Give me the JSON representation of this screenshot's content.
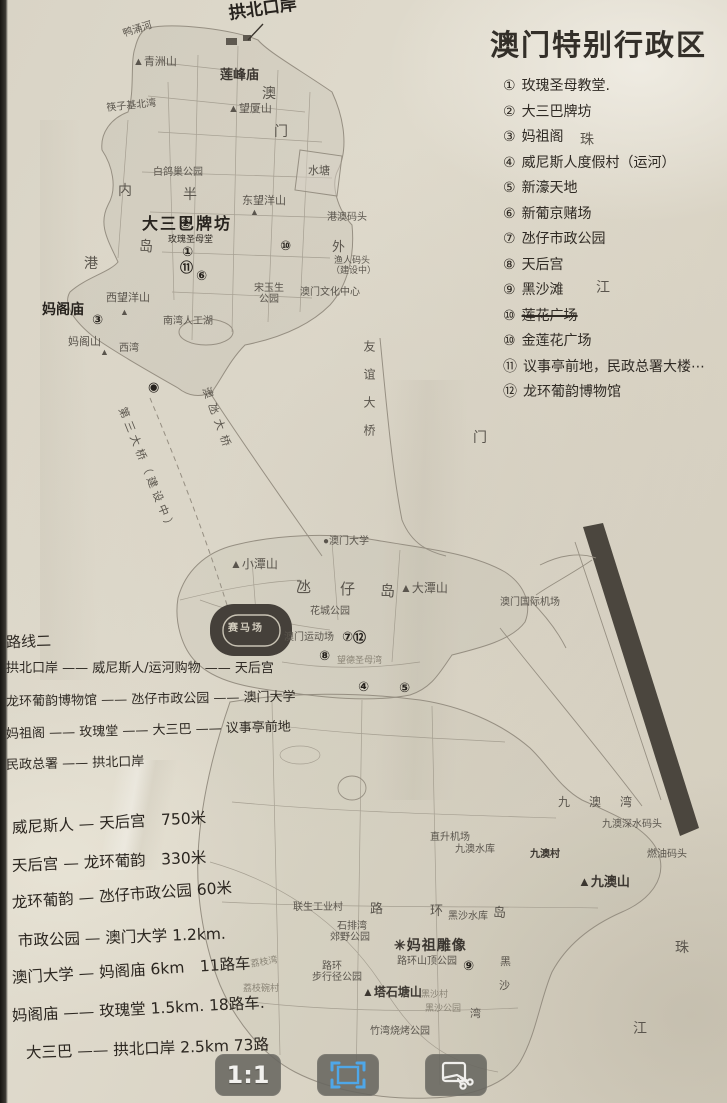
{
  "title": "澳门特别行政区",
  "legend": {
    "items": [
      {
        "num": "①",
        "text": "玫瑰圣母教堂."
      },
      {
        "num": "②",
        "text": "大三巴牌坊"
      },
      {
        "num": "③",
        "text": "妈祖阁"
      },
      {
        "num": "④",
        "text": "威尼斯人度假村（运河）"
      },
      {
        "num": "⑤",
        "text": "新濠天地"
      },
      {
        "num": "⑥",
        "text": "新葡京赌场"
      },
      {
        "num": "⑦",
        "text": "氹仔市政公园"
      },
      {
        "num": "⑧",
        "text": "天后宫"
      },
      {
        "num": "⑨",
        "text": "黑沙滩"
      },
      {
        "num": "⑩",
        "text": "莲花广场",
        "strike": true
      },
      {
        "num": "⑩",
        "text": "金莲花广场"
      },
      {
        "num": "⑪",
        "text": "议事亭前地，民政总署大楼⋯"
      },
      {
        "num": "⑫",
        "text": "龙环葡韵博物馆"
      }
    ]
  },
  "route_notes": {
    "heading": "路线二",
    "lines": [
      "拱北口岸 —— 威尼斯人/运河购物 —— 天后宫",
      "龙环葡韵博物馆 —— 氹仔市政公园 —— 澳门大学",
      "妈祖阁 —— 玫瑰堂 —— 大三巴 —— 议事亭前地",
      "民政总署 —— 拱北口岸"
    ]
  },
  "distance_notes": {
    "lines": [
      "威尼斯人 — 天后宫　750米",
      "天后宫 — 龙环葡韵　330米",
      "龙环葡韵 — 氹仔市政公园 60米",
      "市政公园 — 澳门大学 1.2km.",
      "澳门大学 — 妈阁庙 6km　11路车",
      "妈阁庙 —— 玫瑰堂 1.5km. 18路车.",
      "大三巴 —— 拱北口岸 2.5km 73路"
    ]
  },
  "map": {
    "labels": [
      {
        "t": "拱北口岸",
        "x": 228,
        "y": 6,
        "c": "hb",
        "fs": 17,
        "rot": -8
      },
      {
        "t": "鸭涌河",
        "x": 122,
        "y": 30,
        "c": "p",
        "rot": -18,
        "fs": 10
      },
      {
        "t": "▲青洲山",
        "x": 133,
        "y": 57,
        "c": "p",
        "fs": 11
      },
      {
        "t": "莲峰庙",
        "x": 220,
        "y": 68,
        "c": "pb",
        "fs": 13
      },
      {
        "t": "澳",
        "x": 262,
        "y": 88,
        "c": "p",
        "fs": 14
      },
      {
        "t": "门",
        "x": 274,
        "y": 126,
        "c": "p",
        "fs": 14
      },
      {
        "t": "▲望厦山",
        "x": 228,
        "y": 104,
        "c": "p",
        "fs": 11
      },
      {
        "t": "筷子基北湾",
        "x": 106,
        "y": 104,
        "c": "p",
        "rot": -6,
        "fs": 10
      },
      {
        "t": "水塘",
        "x": 308,
        "y": 166,
        "c": "p",
        "fs": 11
      },
      {
        "t": "内",
        "x": 118,
        "y": 185,
        "c": "p",
        "fs": 14
      },
      {
        "t": "港",
        "x": 84,
        "y": 258,
        "c": "p",
        "fs": 14
      },
      {
        "t": "半",
        "x": 183,
        "y": 189,
        "c": "p",
        "fs": 14
      },
      {
        "t": "岛",
        "x": 139,
        "y": 241,
        "c": "p",
        "fs": 14
      },
      {
        "t": "白鸽巢公园",
        "x": 153,
        "y": 168,
        "c": "p",
        "fs": 10
      },
      {
        "t": "东望洋山",
        "x": 242,
        "y": 196,
        "c": "p",
        "fs": 11
      },
      {
        "t": "▲",
        "x": 250,
        "y": 208,
        "c": "p",
        "fs": 9
      },
      {
        "t": "港澳码头",
        "x": 327,
        "y": 213,
        "c": "p",
        "fs": 10
      },
      {
        "t": "大三巴牌坊",
        "x": 142,
        "y": 216,
        "c": "hb",
        "fs": 16,
        "ls": 2
      },
      {
        "t": "玫瑰圣母堂",
        "x": 168,
        "y": 236,
        "c": "h",
        "fs": 9
      },
      {
        "t": "外",
        "x": 332,
        "y": 240,
        "c": "p",
        "fs": 13
      },
      {
        "t": "渔人码头",
        "x": 334,
        "y": 256,
        "c": "p",
        "fs": 9
      },
      {
        "t": "（建设中）",
        "x": 331,
        "y": 266,
        "c": "p",
        "fs": 9
      },
      {
        "t": "珠",
        "x": 580,
        "y": 134,
        "c": "p",
        "fs": 14
      },
      {
        "t": "江",
        "x": 596,
        "y": 282,
        "c": "p",
        "fs": 14
      },
      {
        "t": "宋玉生",
        "x": 254,
        "y": 284,
        "c": "p",
        "fs": 10
      },
      {
        "t": "公园",
        "x": 259,
        "y": 295,
        "c": "p",
        "fs": 10
      },
      {
        "t": "澳门文化中心",
        "x": 300,
        "y": 288,
        "c": "p",
        "fs": 10
      },
      {
        "t": "南湾人工湖",
        "x": 163,
        "y": 317,
        "c": "p",
        "fs": 10
      },
      {
        "t": "西望洋山",
        "x": 106,
        "y": 293,
        "c": "p",
        "fs": 11
      },
      {
        "t": "▲",
        "x": 120,
        "y": 308,
        "c": "p",
        "fs": 9
      },
      {
        "t": "妈阁庙",
        "x": 42,
        "y": 303,
        "c": "hb",
        "fs": 14
      },
      {
        "t": "妈阁山",
        "x": 68,
        "y": 337,
        "c": "p",
        "fs": 11
      },
      {
        "t": "▲",
        "x": 100,
        "y": 348,
        "c": "p",
        "fs": 9
      },
      {
        "t": "西湾",
        "x": 119,
        "y": 344,
        "c": "p",
        "fs": 10
      },
      {
        "t": "第三大桥（建设中）",
        "x": 126,
        "y": 406,
        "c": "p",
        "rot": 68,
        "ls": 4,
        "fs": 11
      },
      {
        "t": "澳氹大桥",
        "x": 210,
        "y": 386,
        "c": "p",
        "rot": 70,
        "ls": 6,
        "fs": 11
      },
      {
        "t": "友谊大桥",
        "x": 363,
        "y": 340,
        "c": "p",
        "vert": true,
        "ls": 16,
        "fs": 12
      },
      {
        "t": "门",
        "x": 473,
        "y": 432,
        "c": "p",
        "fs": 14
      },
      {
        "t": "●澳门大学",
        "x": 323,
        "y": 537,
        "c": "p",
        "fs": 10
      },
      {
        "t": "▲小潭山",
        "x": 230,
        "y": 558,
        "c": "p",
        "fs": 12
      },
      {
        "t": "氹",
        "x": 296,
        "y": 581,
        "c": "p",
        "fs": 15
      },
      {
        "t": "仔",
        "x": 340,
        "y": 583,
        "c": "p",
        "fs": 15
      },
      {
        "t": "岛",
        "x": 380,
        "y": 585,
        "c": "p",
        "fs": 15
      },
      {
        "t": "▲大潭山",
        "x": 400,
        "y": 582,
        "c": "p",
        "fs": 12
      },
      {
        "t": "花城公园",
        "x": 310,
        "y": 607,
        "c": "p",
        "fs": 10
      },
      {
        "t": "澳门运动场",
        "x": 284,
        "y": 633,
        "c": "p",
        "fs": 10
      },
      {
        "t": "赛马场",
        "x": 228,
        "y": 624,
        "c": "lt",
        "fs": 10,
        "ls": 2
      },
      {
        "t": "澳门国际机场",
        "x": 500,
        "y": 598,
        "c": "p",
        "fs": 10
      },
      {
        "t": "望德圣母湾",
        "x": 337,
        "y": 656,
        "c": "f",
        "fs": 9
      },
      {
        "t": "九 澳 湾",
        "x": 558,
        "y": 796,
        "c": "p",
        "fs": 12,
        "ls": 8
      },
      {
        "t": "九澳深水码头",
        "x": 602,
        "y": 820,
        "c": "p",
        "fs": 10
      },
      {
        "t": "直升机场",
        "x": 430,
        "y": 833,
        "c": "p",
        "fs": 10
      },
      {
        "t": "九澳水库",
        "x": 455,
        "y": 845,
        "c": "p",
        "fs": 10
      },
      {
        "t": "九澳村",
        "x": 530,
        "y": 850,
        "c": "pb",
        "fs": 10
      },
      {
        "t": "燃油码头",
        "x": 647,
        "y": 850,
        "c": "p",
        "fs": 10
      },
      {
        "t": "▲九澳山",
        "x": 578,
        "y": 875,
        "c": "pb",
        "fs": 13
      },
      {
        "t": "路",
        "x": 370,
        "y": 902,
        "c": "p",
        "fs": 13
      },
      {
        "t": "环",
        "x": 430,
        "y": 904,
        "c": "p",
        "fs": 13
      },
      {
        "t": "岛",
        "x": 493,
        "y": 906,
        "c": "p",
        "fs": 13
      },
      {
        "t": "黑沙水库",
        "x": 448,
        "y": 912,
        "c": "p",
        "fs": 10
      },
      {
        "t": "联生工业村",
        "x": 293,
        "y": 903,
        "c": "p",
        "fs": 10
      },
      {
        "t": "石排湾",
        "x": 337,
        "y": 922,
        "c": "p",
        "fs": 10
      },
      {
        "t": "郊野公园",
        "x": 330,
        "y": 933,
        "c": "p",
        "fs": 10
      },
      {
        "t": "荔枝湾",
        "x": 250,
        "y": 960,
        "c": "f",
        "fs": 9,
        "rot": -10
      },
      {
        "t": "荔枝碗村",
        "x": 243,
        "y": 984,
        "c": "f",
        "fs": 9
      },
      {
        "t": "✳妈祖雕像",
        "x": 394,
        "y": 940,
        "c": "pb",
        "fs": 14,
        "ls": 1
      },
      {
        "t": "路环山顶公园",
        "x": 397,
        "y": 957,
        "c": "p",
        "fs": 10
      },
      {
        "t": "路环",
        "x": 322,
        "y": 962,
        "c": "p",
        "fs": 10
      },
      {
        "t": "步行径公园",
        "x": 312,
        "y": 973,
        "c": "p",
        "fs": 10
      },
      {
        "t": "▲塔石塘山",
        "x": 362,
        "y": 986,
        "c": "pb",
        "fs": 12
      },
      {
        "t": "黑沙村",
        "x": 421,
        "y": 990,
        "c": "f",
        "fs": 9
      },
      {
        "t": "黑沙公园",
        "x": 425,
        "y": 1004,
        "c": "f",
        "fs": 9
      },
      {
        "t": "黑",
        "x": 500,
        "y": 957,
        "c": "p",
        "fs": 11
      },
      {
        "t": "沙",
        "x": 499,
        "y": 981,
        "c": "p",
        "fs": 11
      },
      {
        "t": "湾",
        "x": 470,
        "y": 1009,
        "c": "p",
        "fs": 11
      },
      {
        "t": "竹湾烧烤公园",
        "x": 370,
        "y": 1027,
        "c": "p",
        "fs": 10
      },
      {
        "t": "珠",
        "x": 675,
        "y": 942,
        "c": "p",
        "fs": 14
      },
      {
        "t": "江",
        "x": 633,
        "y": 1023,
        "c": "p",
        "fs": 14
      }
    ],
    "marks": [
      {
        "t": "②",
        "x": 180,
        "y": 218
      },
      {
        "t": "①",
        "x": 182,
        "y": 246
      },
      {
        "t": "⑪",
        "x": 180,
        "y": 262
      },
      {
        "t": "⑥",
        "x": 196,
        "y": 270
      },
      {
        "t": "⑩",
        "x": 280,
        "y": 240
      },
      {
        "t": "③",
        "x": 92,
        "y": 314
      },
      {
        "t": "◉",
        "x": 148,
        "y": 381
      },
      {
        "t": "⑦",
        "x": 342,
        "y": 631
      },
      {
        "t": "⑫",
        "x": 353,
        "y": 632
      },
      {
        "t": "⑧",
        "x": 319,
        "y": 650
      },
      {
        "t": "④",
        "x": 358,
        "y": 681
      },
      {
        "t": "⑤",
        "x": 399,
        "y": 682
      },
      {
        "t": "⑨",
        "x": 463,
        "y": 960
      }
    ]
  },
  "toolbar": {
    "buttons": [
      {
        "name": "actual-size-button",
        "label": "1:1"
      },
      {
        "name": "fit-screen-button",
        "icon": "fit-frame-icon",
        "accent": "#4fa7e8",
        "active": true
      },
      {
        "name": "crop-button",
        "icon": "crop-scissors-icon"
      }
    ]
  },
  "colors": {
    "paper": "#dcd7c9",
    "handwriting_ink": "#2f2a24",
    "printed_map_text": "#55504a",
    "map_lines": "#968f82",
    "toolbar_background": "#686660",
    "accent_blue": "#4fa7e8",
    "icon_white": "#f0efec"
  }
}
